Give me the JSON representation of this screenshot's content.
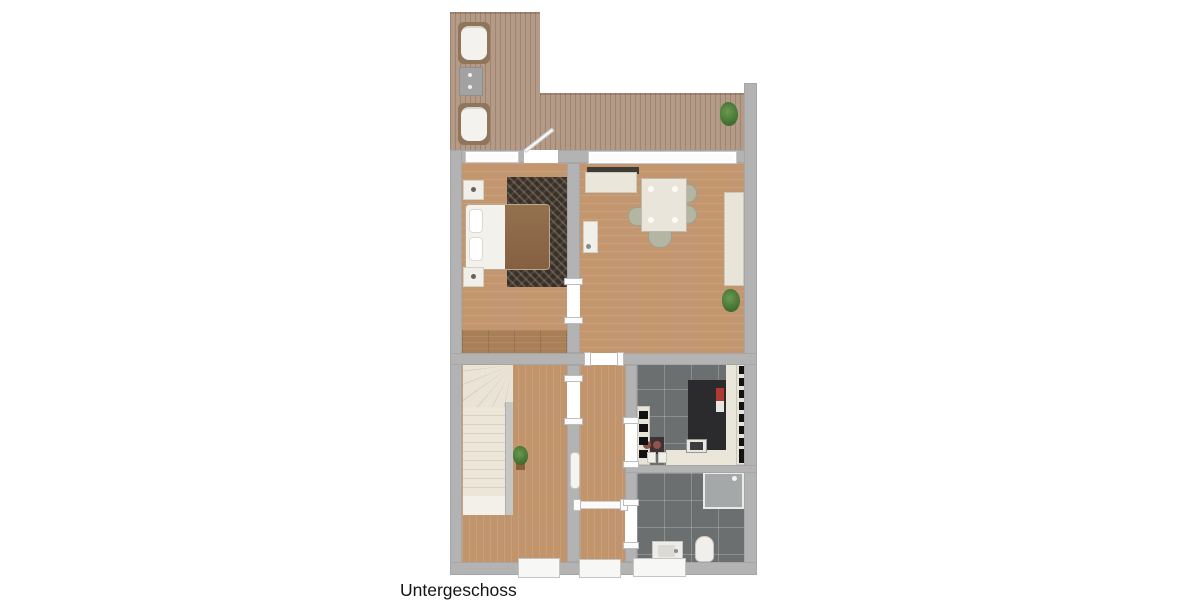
{
  "title": {
    "floor_label": "Untergeschoss"
  },
  "colors": {
    "wall": "#b2b3b2",
    "deck_wood": "#b49b88",
    "room_wood": "#c99c74",
    "dark_tile": "#6b6f70",
    "counter_cream": "#ebe6da",
    "countertop_dark": "#2b2a2c",
    "stair_cream": "#eae4d7",
    "rug_dark": "#38302a",
    "blanket_brown": "#8b6a4b",
    "chair_sage": "#b4b6a4",
    "plant_green": "#4a7a36",
    "accent_red": "#b03a32"
  },
  "items_depicted": [
    "sun-lounger",
    "terrace-table",
    "potted-plant",
    "double-bed",
    "nightstand",
    "area-rug",
    "wardrobe",
    "sideboard",
    "dining-table",
    "dining-chair",
    "wall-cabinet",
    "desk",
    "staircase",
    "radiator",
    "interior-door",
    "kitchen-counter",
    "kitchen-sink",
    "storage-shelf",
    "shower",
    "washbasin",
    "toilet",
    "window",
    "entrance-door"
  ]
}
